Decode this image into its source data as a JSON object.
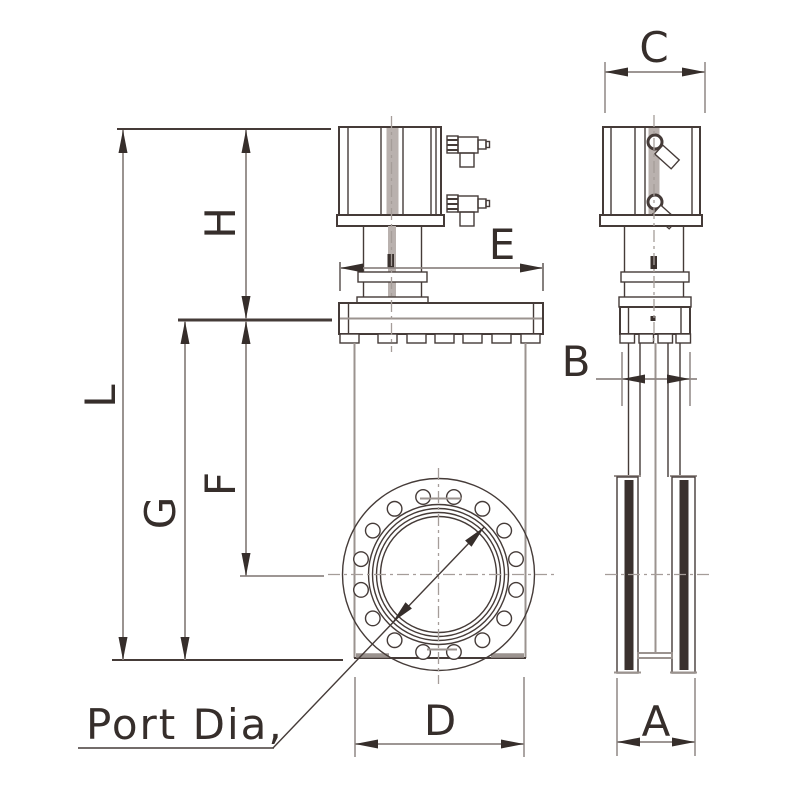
{
  "labels": {
    "L": "L",
    "H": "H",
    "G": "G",
    "F": "F",
    "E": "E",
    "C": "C",
    "B": "B",
    "A": "A",
    "D": "D"
  },
  "port_label": "Port Dia,",
  "colors": {
    "bg": "#ffffff",
    "line_dark": "#453b38",
    "line_gray": "#9b938f",
    "dim_line": "#8f8784",
    "centerline": "#a59d99",
    "text": "#362e2b",
    "rod_fill": "#b9b1ae",
    "bar_fill": "#3a312e"
  }
}
